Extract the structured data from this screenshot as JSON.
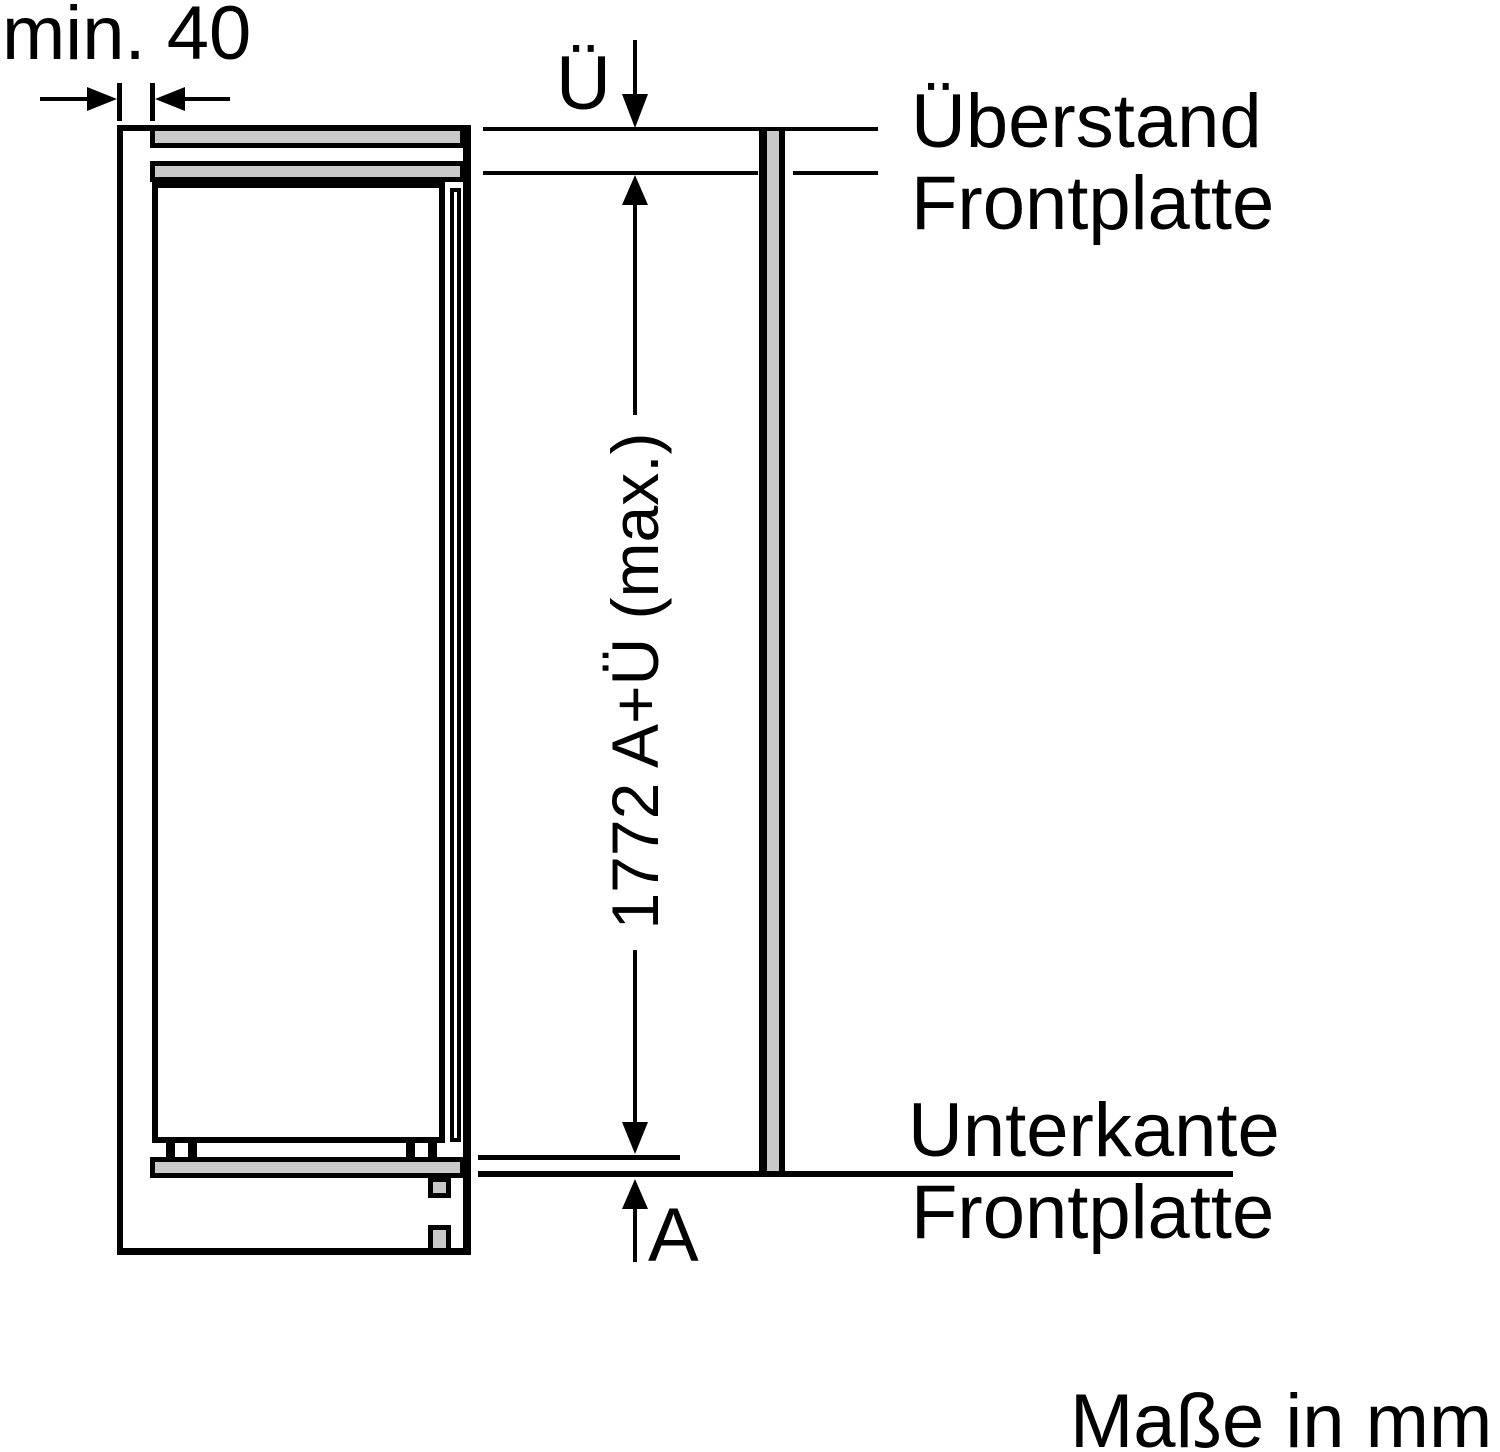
{
  "diagram": {
    "title": "built-in appliance niche dimension drawing",
    "units_note": "Maße in mm",
    "dimensions": {
      "wall_clearance": {
        "label": "min. 40"
      },
      "overhang": {
        "symbol": "Ü",
        "label_line1": "Überstand",
        "label_line2": "Frontplatte"
      },
      "niche_height": {
        "label": "1772 A+Ü (max.)"
      },
      "bottom_edge": {
        "symbol": "A",
        "label_line1": "Unterkante",
        "label_line2": "Frontplatte"
      }
    },
    "colors": {
      "line": "#000000",
      "panel_fill": "#c9c9c9",
      "background": "#ffffff"
    }
  }
}
